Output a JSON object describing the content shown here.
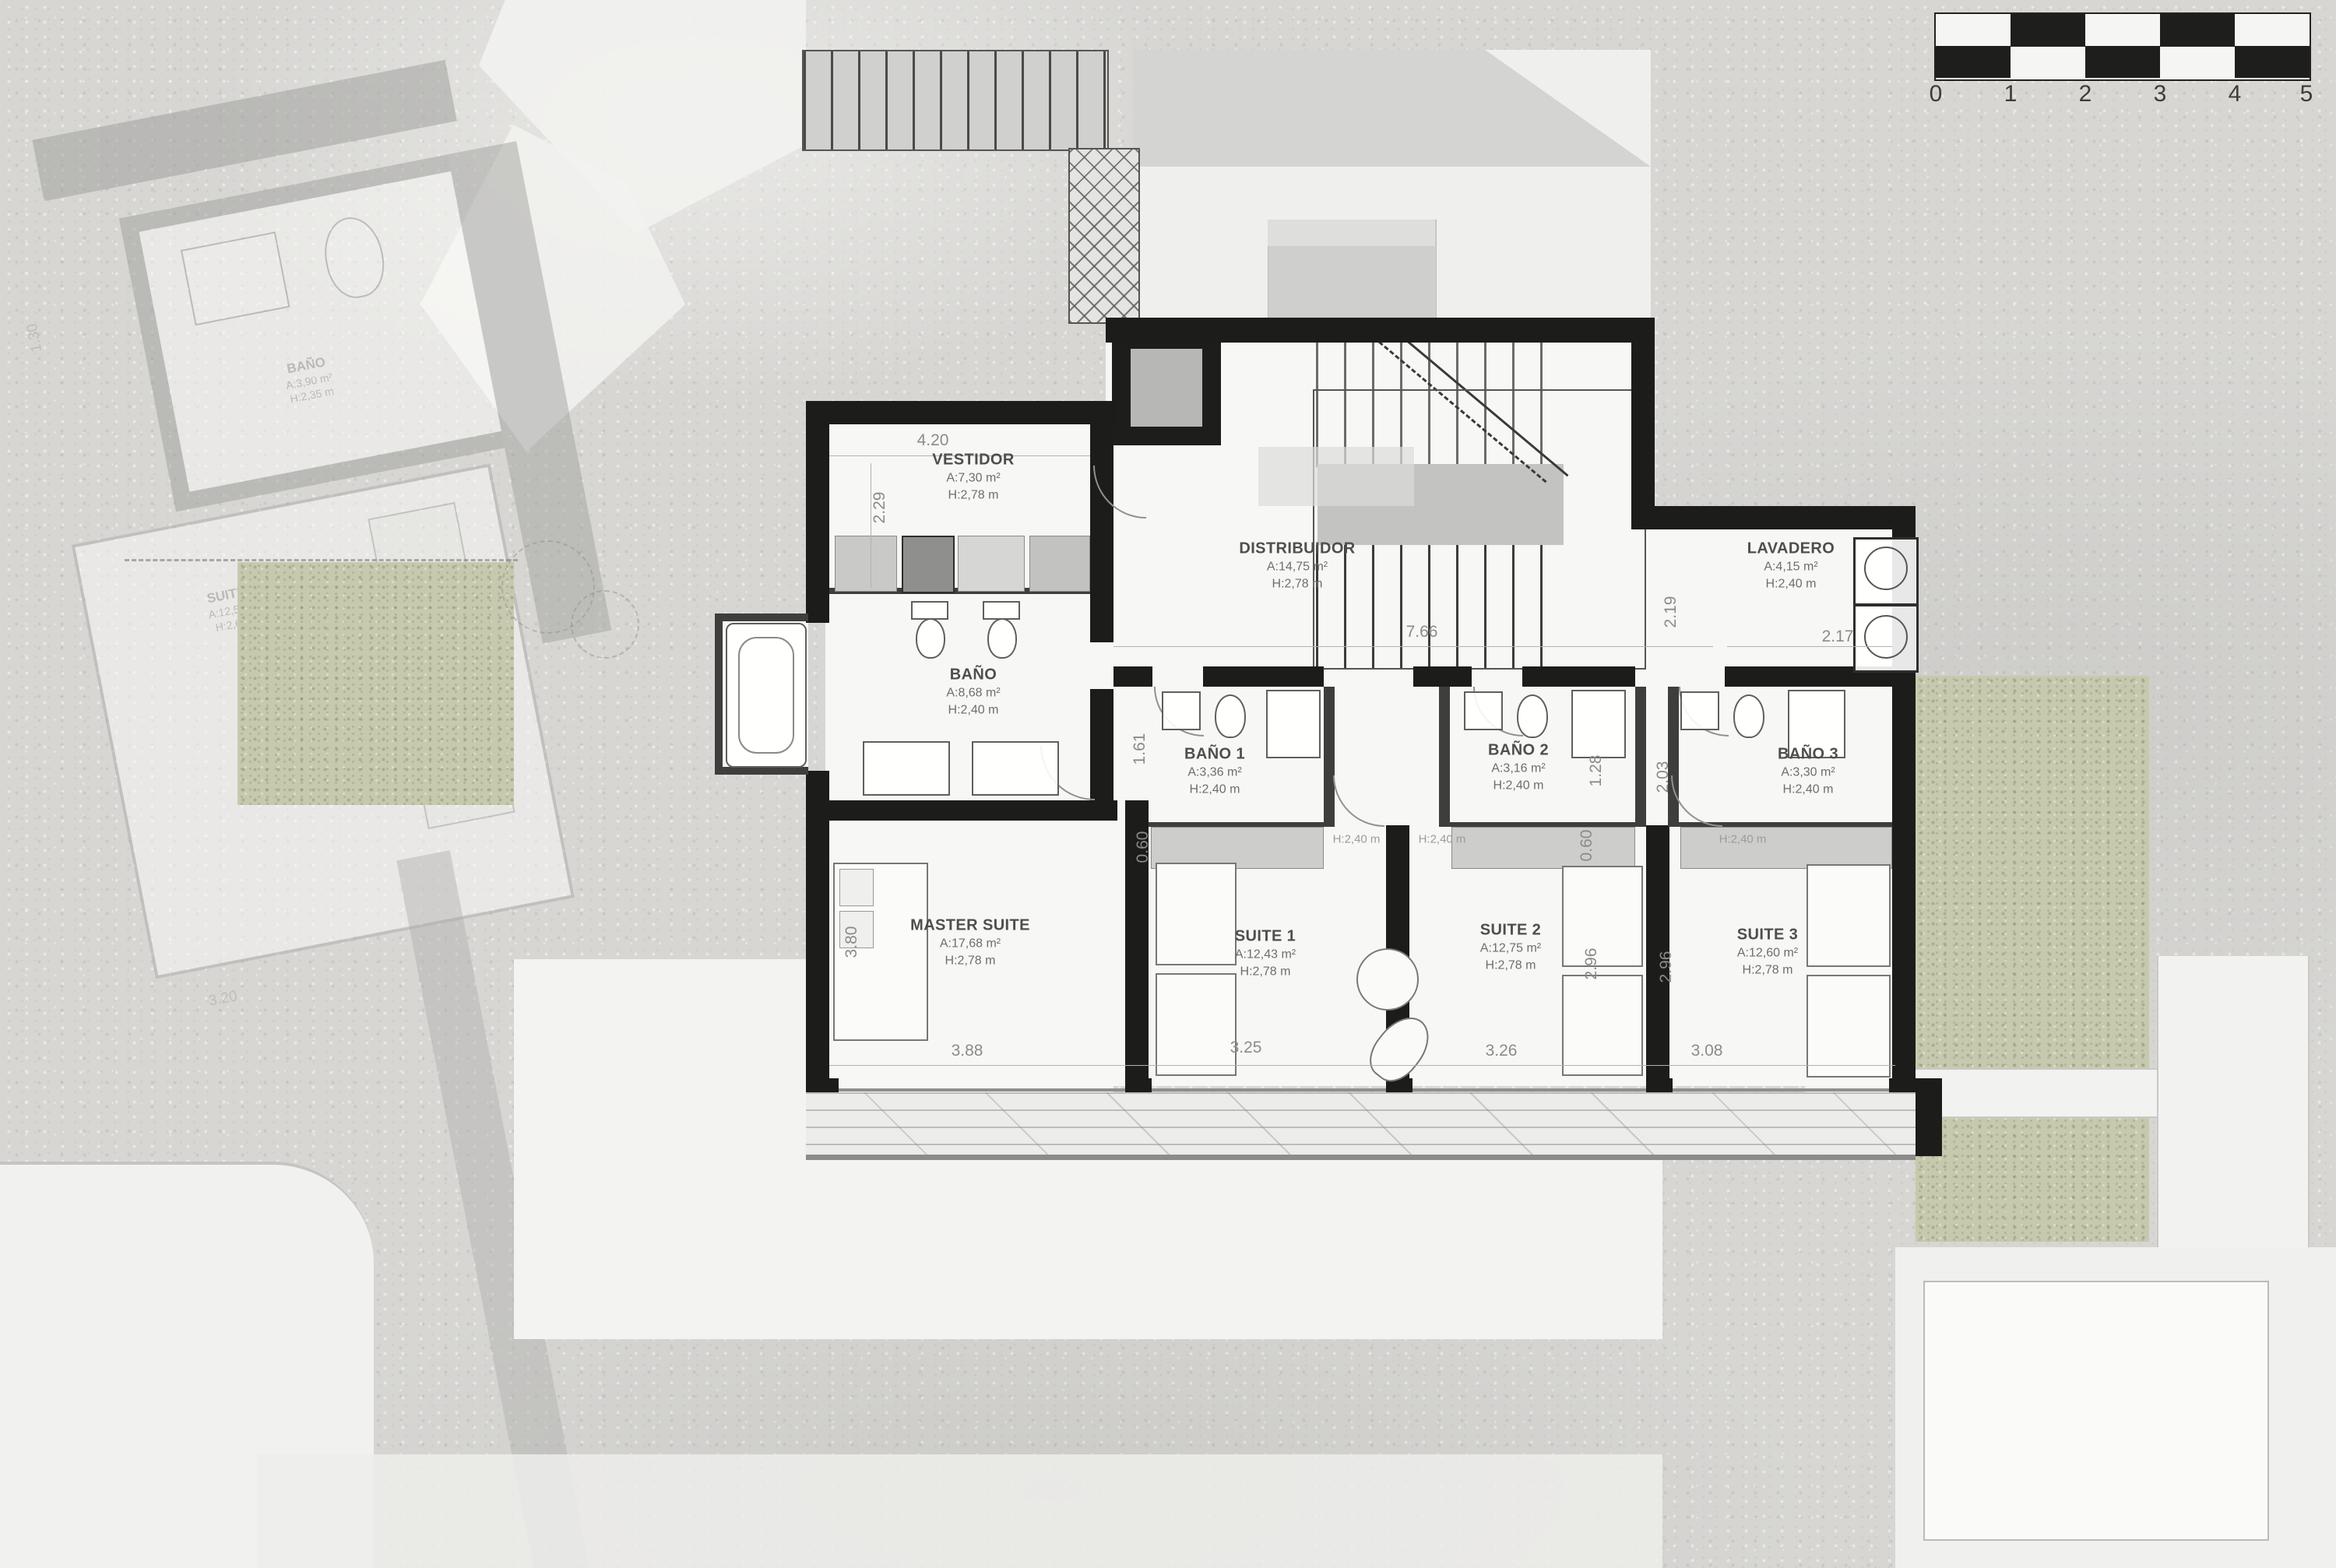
{
  "scalebar": {
    "labels": [
      "0",
      "1",
      "2",
      "3",
      "4",
      "5"
    ]
  },
  "rooms": [
    {
      "name": "VESTIDOR",
      "area": "A:7,30 m²",
      "height": "H:2,78 m"
    },
    {
      "name": "BAÑO",
      "area": "A:8,68 m²",
      "height": "H:2,40 m"
    },
    {
      "name": "DISTRIBUIDOR",
      "area": "A:14,75 m²",
      "height": "H:2,78 m"
    },
    {
      "name": "LAVADERO",
      "area": "A:4,15 m²",
      "height": "H:2,40 m"
    },
    {
      "name": "BAÑO 1",
      "area": "A:3,36 m²",
      "height": "H:2,40 m"
    },
    {
      "name": "BAÑO 2",
      "area": "A:3,16 m²",
      "height": "H:2,40 m"
    },
    {
      "name": "BAÑO 3",
      "area": "A:3,30 m²",
      "height": "H:2,40 m"
    },
    {
      "name": "MASTER SUITE",
      "area": "A:17,68 m²",
      "height": "H:2,78 m"
    },
    {
      "name": "SUITE 1",
      "area": "A:12,43 m²",
      "height": "H:2,78 m"
    },
    {
      "name": "SUITE 2",
      "area": "A:12,75 m²",
      "height": "H:2,78 m"
    },
    {
      "name": "SUITE 3",
      "area": "A:12,60 m²",
      "height": "H:2,78 m"
    }
  ],
  "dims": [
    "4.20",
    "2.29",
    "7.66",
    "2.17",
    "2.19",
    "1.61",
    "1.28",
    "2.03",
    "0.60",
    "0.60",
    "2.96",
    "2.96",
    "3.80",
    "3.88",
    "3.25",
    "3.26",
    "3.08"
  ],
  "lintels": [
    "H:2,40 m",
    "H:2,40 m",
    "H:2,40 m"
  ],
  "neighbor": {
    "bath": {
      "name": "BAÑO",
      "area": "A:3,90 m²",
      "height": "H:2,35 m"
    },
    "suite": {
      "name": "SUITE 5",
      "area": "A:12,50 m²",
      "height": "H:2,66 m"
    },
    "dims": [
      "3.20",
      "1.30"
    ]
  }
}
